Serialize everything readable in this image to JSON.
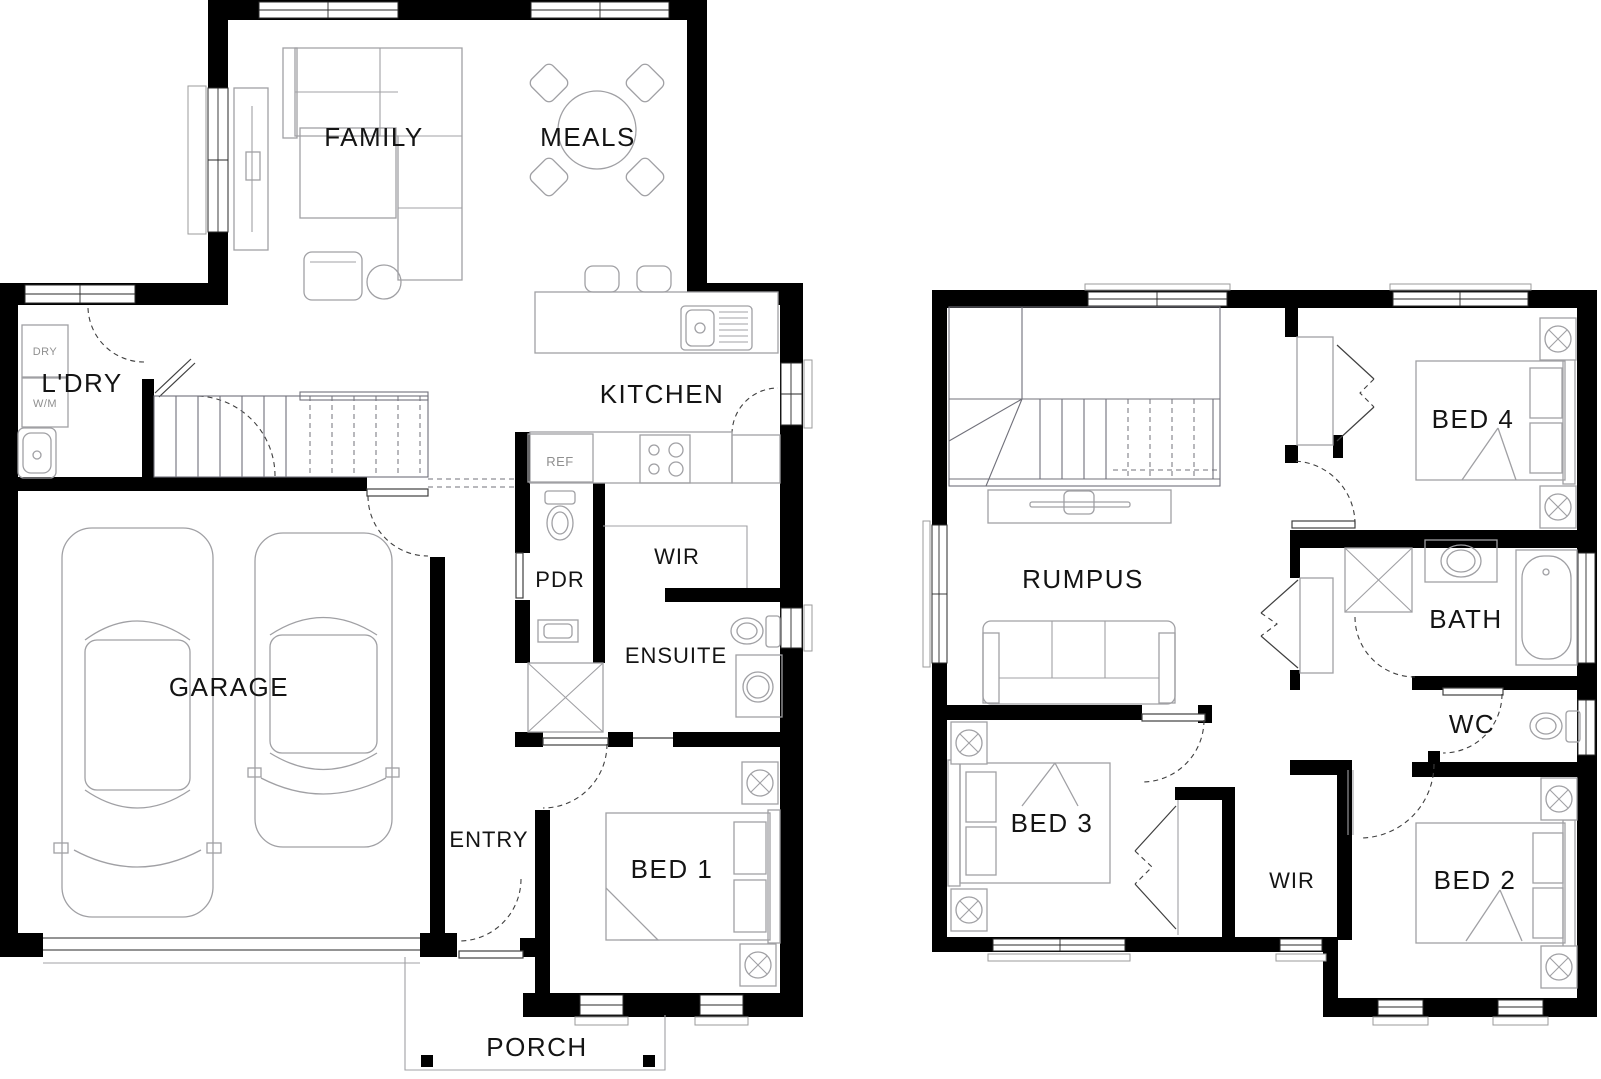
{
  "colors": {
    "wall": "#000000",
    "furniture": "#a0a0a4",
    "door": "#3f3f3f",
    "text": "#141414",
    "muted": "#8f8f8f",
    "bg": "#ffffff"
  },
  "plan_type": "two-storey house floor plan",
  "ground": {
    "name": "ground-floor",
    "labels": {
      "family": "FAMILY",
      "meals": "MEALS",
      "kitchen": "KITCHEN",
      "laundry": "L'DRY",
      "dry": "DRY",
      "wm": "W/M",
      "ref": "REF",
      "pdr": "PDR",
      "wir": "WIR",
      "ensuite": "ENSUITE",
      "garage": "GARAGE",
      "entry": "ENTRY",
      "bed1": "BED 1",
      "porch": "PORCH"
    }
  },
  "upper": {
    "name": "upper-floor",
    "labels": {
      "rumpus": "RUMPUS",
      "bed4": "BED 4",
      "bath": "BATH",
      "wc": "WC",
      "bed3": "BED 3",
      "wir": "WIR",
      "bed2": "BED 2"
    }
  }
}
